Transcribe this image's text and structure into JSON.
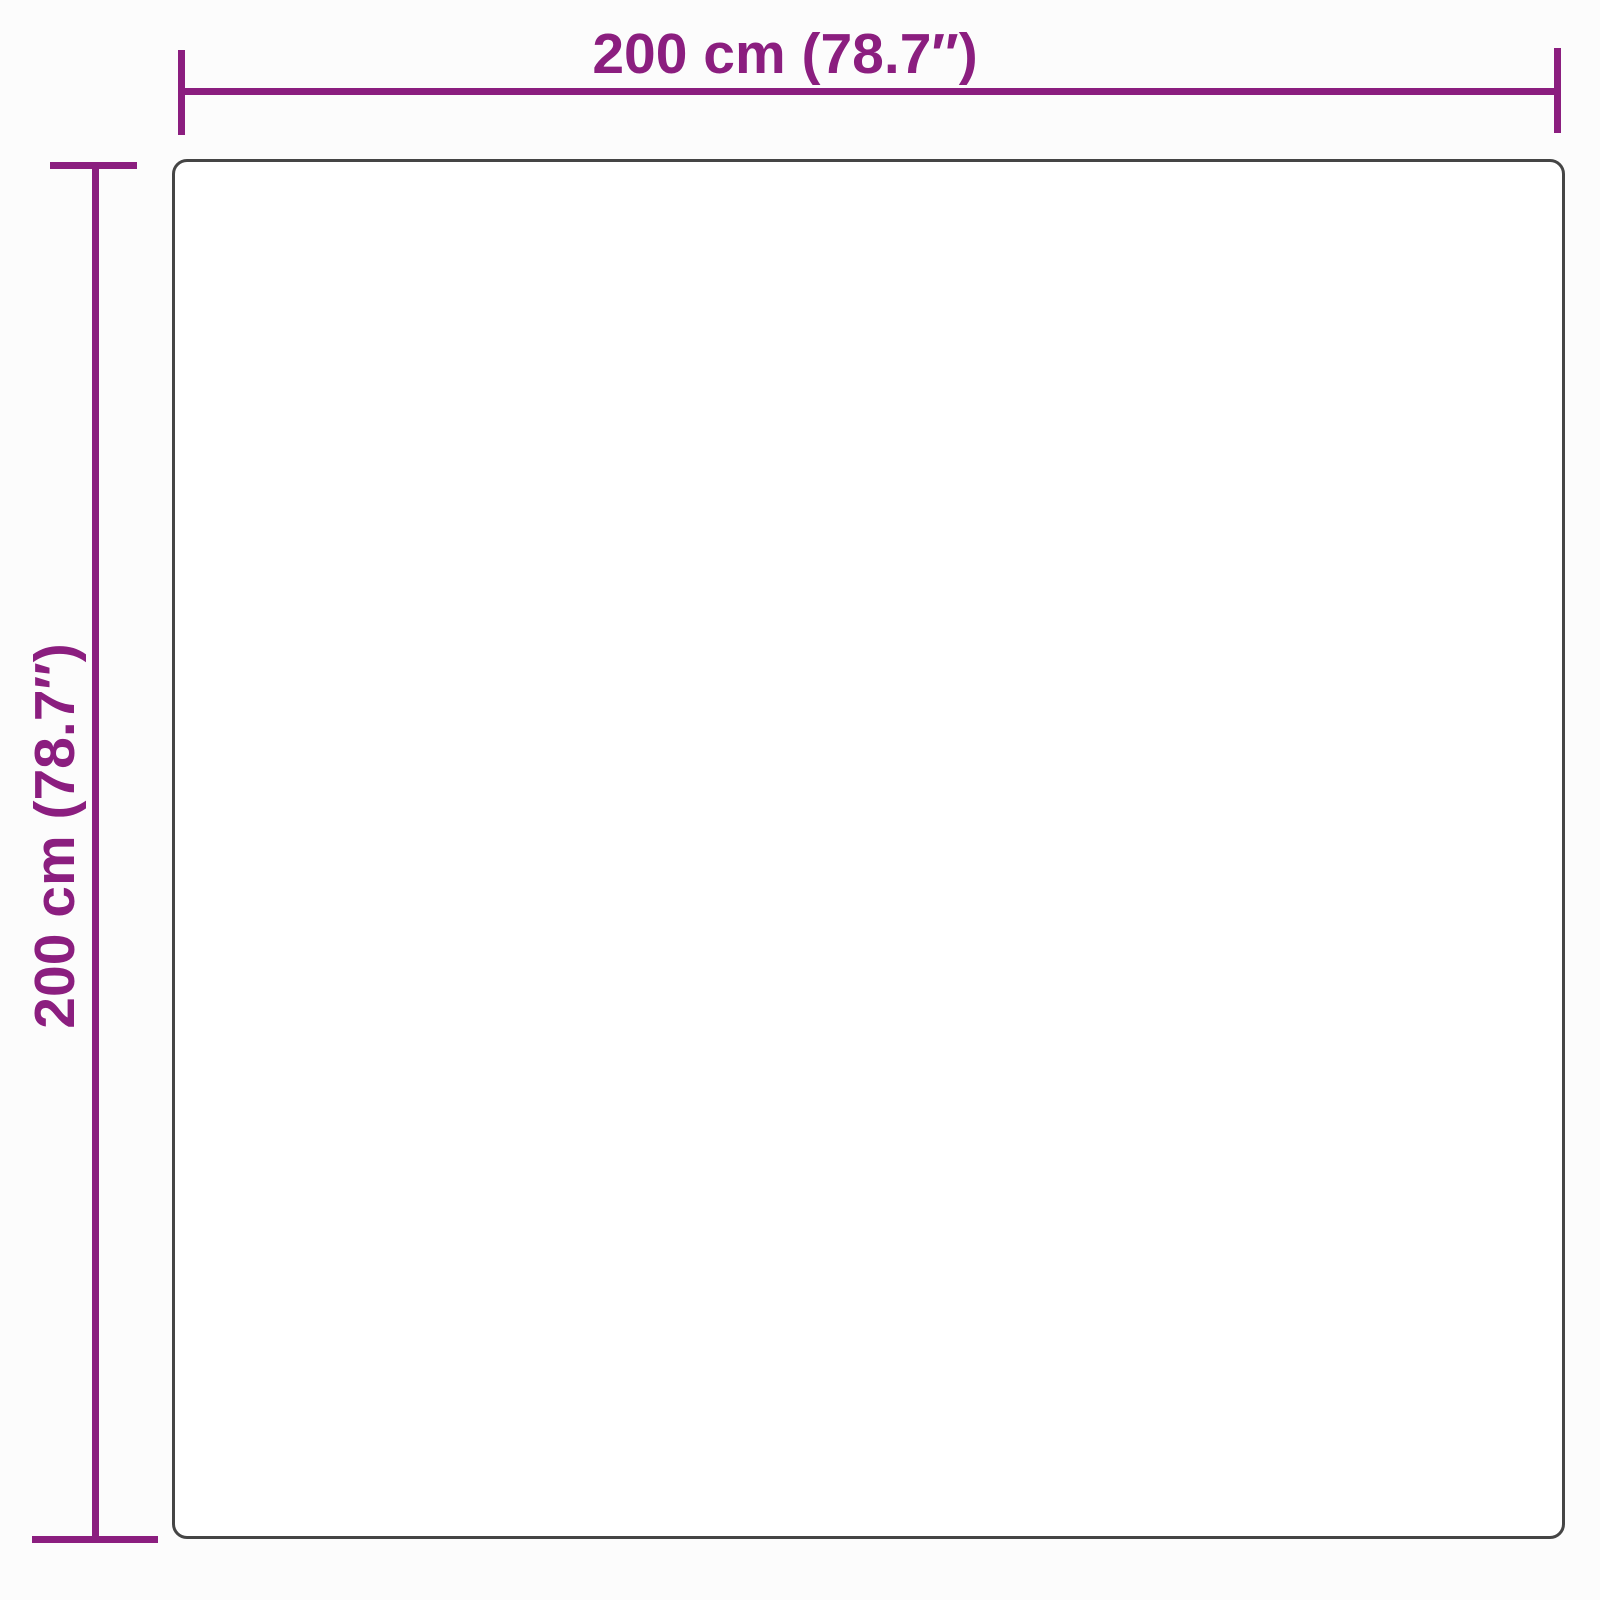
{
  "diagram": {
    "type": "product-dimension-diagram",
    "shape": "square",
    "width_dimension": {
      "label": "200 cm (78.7″)",
      "value_cm": 200,
      "value_inches": 78.7
    },
    "height_dimension": {
      "label": "200 cm (78.7″)",
      "value_cm": 200,
      "value_inches": 78.7
    },
    "colors": {
      "dimension": "#8B1E7F",
      "outline": "#454545",
      "canvas": "#fcfcfc",
      "product-fill": "#ffffff"
    }
  }
}
